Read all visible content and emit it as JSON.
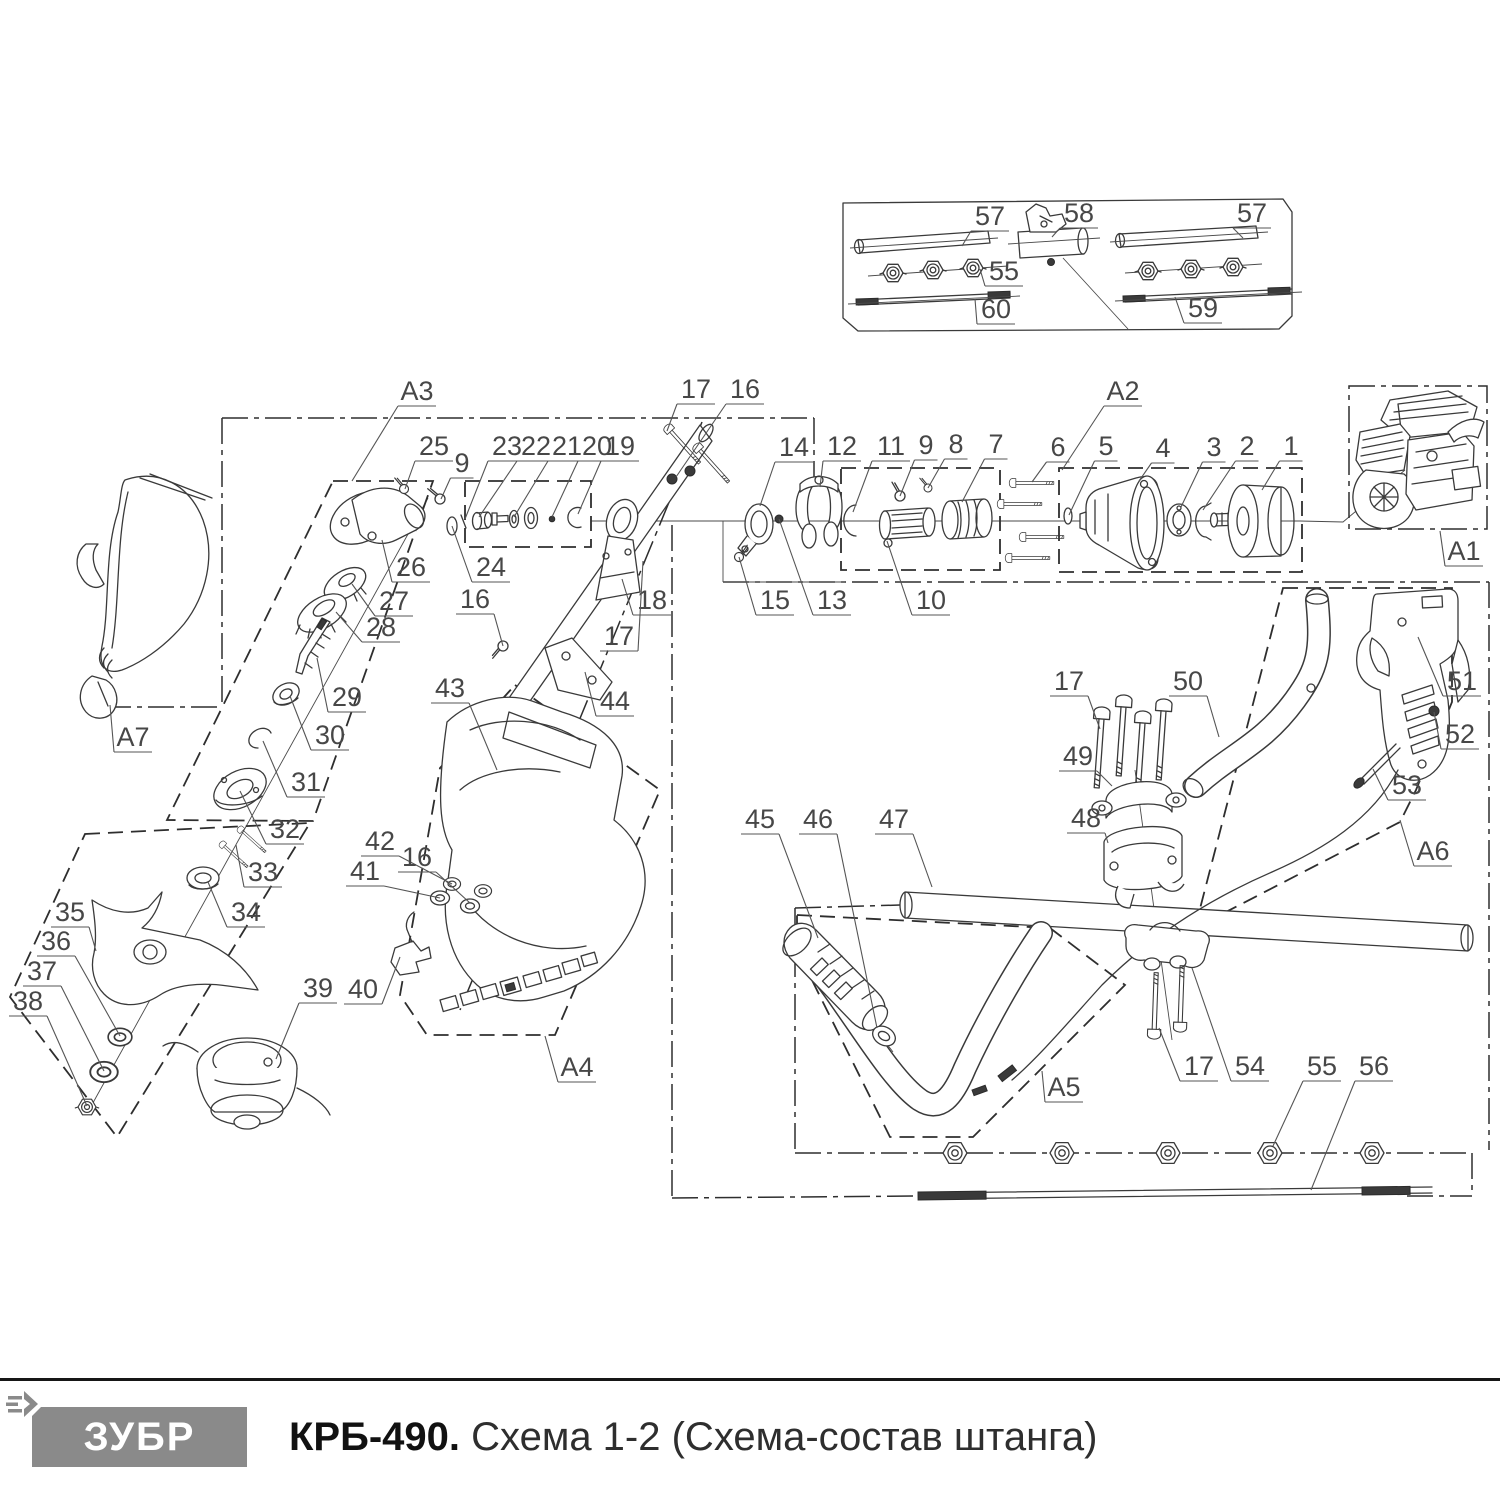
{
  "doc": {
    "type": "exploded-parts-diagram",
    "product_line": "brush cutter shaft assembly"
  },
  "colors": {
    "line": "#3a3a3a",
    "label": "#474747",
    "logo_bg": "#8a8a8a",
    "logo_fg": "#ffffff",
    "footer_rule": "#161616"
  },
  "footer": {
    "brand": "ЗУБР",
    "model": "КРБ-490.",
    "schema_title": "Схема 1-2 (Схема-состав штанга)"
  },
  "assembly_boxes": [
    "A1",
    "A2",
    "A3",
    "A4",
    "A5",
    "A6",
    "A7"
  ],
  "callouts": [
    {
      "t": "57",
      "x": 990,
      "y": 216,
      "px": 962,
      "py": 246
    },
    {
      "t": "58",
      "x": 1079,
      "y": 213,
      "px": 1052,
      "py": 237
    },
    {
      "t": "57",
      "x": 1252,
      "y": 213,
      "px": 1243,
      "py": 238
    },
    {
      "t": "55",
      "x": 1004,
      "y": 271,
      "px": 980,
      "py": 269
    },
    {
      "t": "60",
      "x": 996,
      "y": 309,
      "px": 975,
      "py": 299
    },
    {
      "t": "59",
      "x": 1203,
      "y": 308,
      "px": 1175,
      "py": 297
    },
    {
      "t": "A3",
      "x": 417,
      "y": 391,
      "px": 352,
      "py": 481
    },
    {
      "t": "25",
      "x": 434,
      "y": 446,
      "px": 405,
      "py": 489
    },
    {
      "t": "9",
      "x": 462,
      "y": 463,
      "px": 441,
      "py": 499
    },
    {
      "t": "23",
      "x": 507,
      "y": 446,
      "px": 465,
      "py": 519
    },
    {
      "t": "22",
      "x": 536,
      "y": 446,
      "px": 479,
      "py": 517
    },
    {
      "t": "21",
      "x": 567,
      "y": 446,
      "px": 514,
      "py": 517
    },
    {
      "t": "20",
      "x": 597,
      "y": 446,
      "px": 552,
      "py": 517
    },
    {
      "t": "19",
      "x": 620,
      "y": 446,
      "px": 578,
      "py": 514
    },
    {
      "t": "17",
      "x": 696,
      "y": 389,
      "px": 667,
      "py": 431
    },
    {
      "t": "16",
      "x": 745,
      "y": 389,
      "px": 676,
      "py": 477
    },
    {
      "t": "14",
      "x": 794,
      "y": 447,
      "px": 760,
      "py": 506
    },
    {
      "t": "12",
      "x": 842,
      "y": 446,
      "px": 820,
      "py": 487
    },
    {
      "t": "11",
      "x": 891,
      "y": 446,
      "px": 853,
      "py": 512
    },
    {
      "t": "9",
      "x": 926,
      "y": 445,
      "px": 900,
      "py": 496
    },
    {
      "t": "8",
      "x": 956,
      "y": 444,
      "px": 928,
      "py": 488
    },
    {
      "t": "7",
      "x": 996,
      "y": 444,
      "px": 962,
      "py": 502
    },
    {
      "t": "6",
      "x": 1058,
      "y": 447,
      "px": 1032,
      "py": 482
    },
    {
      "t": "5",
      "x": 1106,
      "y": 446,
      "px": 1069,
      "py": 515
    },
    {
      "t": "4",
      "x": 1163,
      "y": 448,
      "px": 1139,
      "py": 481
    },
    {
      "t": "3",
      "x": 1214,
      "y": 447,
      "px": 1181,
      "py": 507
    },
    {
      "t": "2",
      "x": 1247,
      "y": 446,
      "px": 1203,
      "py": 510
    },
    {
      "t": "1",
      "x": 1291,
      "y": 446,
      "px": 1262,
      "py": 490
    },
    {
      "t": "A2",
      "x": 1123,
      "y": 391,
      "px": 1062,
      "py": 470
    },
    {
      "t": "A1",
      "x": 1464,
      "y": 551,
      "px": 1440,
      "py": 531
    },
    {
      "t": "26",
      "x": 411,
      "y": 567,
      "px": 382,
      "py": 540
    },
    {
      "t": "24",
      "x": 491,
      "y": 567,
      "px": 452,
      "py": 526
    },
    {
      "t": "27",
      "x": 394,
      "y": 601,
      "px": 352,
      "py": 584
    },
    {
      "t": "28",
      "x": 381,
      "y": 627,
      "px": 336,
      "py": 612
    },
    {
      "t": "29",
      "x": 347,
      "y": 697,
      "px": 317,
      "py": 658
    },
    {
      "t": "30",
      "x": 330,
      "y": 735,
      "px": 290,
      "py": 696
    },
    {
      "t": "31",
      "x": 306,
      "y": 782,
      "px": 263,
      "py": 741
    },
    {
      "t": "32",
      "x": 285,
      "y": 829,
      "px": 240,
      "py": 791
    },
    {
      "t": "33",
      "x": 263,
      "y": 872,
      "px": 236,
      "py": 845
    },
    {
      "t": "34",
      "x": 246,
      "y": 912,
      "px": 208,
      "py": 882
    },
    {
      "t": "35",
      "x": 70,
      "y": 912,
      "px": 96,
      "py": 951
    },
    {
      "t": "36",
      "x": 56,
      "y": 941,
      "px": 120,
      "py": 1036
    },
    {
      "t": "37",
      "x": 42,
      "y": 971,
      "px": 104,
      "py": 1071
    },
    {
      "t": "38",
      "x": 28,
      "y": 1001,
      "px": 87,
      "py": 1106
    },
    {
      "t": "39",
      "x": 318,
      "y": 988,
      "px": 276,
      "py": 1059
    },
    {
      "t": "A7",
      "x": 133,
      "y": 737,
      "px": 110,
      "py": 705
    },
    {
      "t": "16",
      "x": 475,
      "y": 599,
      "px": 503,
      "py": 646
    },
    {
      "t": "43",
      "x": 450,
      "y": 688,
      "px": 497,
      "py": 770
    },
    {
      "t": "18",
      "x": 652,
      "y": 600,
      "px": 622,
      "py": 579
    },
    {
      "t": "17",
      "x": 619,
      "y": 636,
      "px": 643,
      "py": 561
    },
    {
      "t": "44",
      "x": 615,
      "y": 701,
      "px": 585,
      "py": 672
    },
    {
      "t": "42",
      "x": 380,
      "y": 841,
      "px": 452,
      "py": 884
    },
    {
      "t": "41",
      "x": 365,
      "y": 871,
      "px": 440,
      "py": 898
    },
    {
      "t": "16",
      "x": 417,
      "y": 857,
      "px": 470,
      "py": 903
    },
    {
      "t": "40",
      "x": 363,
      "y": 989,
      "px": 400,
      "py": 957
    },
    {
      "t": "A4",
      "x": 577,
      "y": 1067,
      "px": 545,
      "py": 1036
    },
    {
      "t": "15",
      "x": 775,
      "y": 600,
      "px": 739,
      "py": 557
    },
    {
      "t": "13",
      "x": 832,
      "y": 600,
      "px": 779,
      "py": 519
    },
    {
      "t": "10",
      "x": 931,
      "y": 600,
      "px": 887,
      "py": 541
    },
    {
      "t": "17",
      "x": 1069,
      "y": 681,
      "px": 1100,
      "py": 729
    },
    {
      "t": "50",
      "x": 1188,
      "y": 681,
      "px": 1219,
      "py": 737
    },
    {
      "t": "49",
      "x": 1078,
      "y": 756,
      "px": 1112,
      "py": 786
    },
    {
      "t": "48",
      "x": 1086,
      "y": 818,
      "px": 1108,
      "py": 843
    },
    {
      "t": "51",
      "x": 1462,
      "y": 681,
      "px": 1418,
      "py": 637
    },
    {
      "t": "52",
      "x": 1460,
      "y": 734,
      "px": 1434,
      "py": 712
    },
    {
      "t": "53",
      "x": 1407,
      "y": 785,
      "px": 1373,
      "py": 769
    },
    {
      "t": "A6",
      "x": 1433,
      "y": 851,
      "px": 1400,
      "py": 820
    },
    {
      "t": "45",
      "x": 760,
      "y": 819,
      "px": 818,
      "py": 938
    },
    {
      "t": "46",
      "x": 818,
      "y": 819,
      "px": 877,
      "py": 1028
    },
    {
      "t": "47",
      "x": 894,
      "y": 819,
      "px": 932,
      "py": 887
    },
    {
      "t": "A5",
      "x": 1064,
      "y": 1087,
      "px": 1042,
      "py": 1071
    },
    {
      "t": "17",
      "x": 1199,
      "y": 1066,
      "px": 1159,
      "py": 1028
    },
    {
      "t": "54",
      "x": 1250,
      "y": 1066,
      "px": 1192,
      "py": 968
    },
    {
      "t": "55",
      "x": 1322,
      "y": 1066,
      "px": 1273,
      "py": 1146
    },
    {
      "t": "56",
      "x": 1374,
      "y": 1066,
      "px": 1311,
      "py": 1190
    }
  ]
}
